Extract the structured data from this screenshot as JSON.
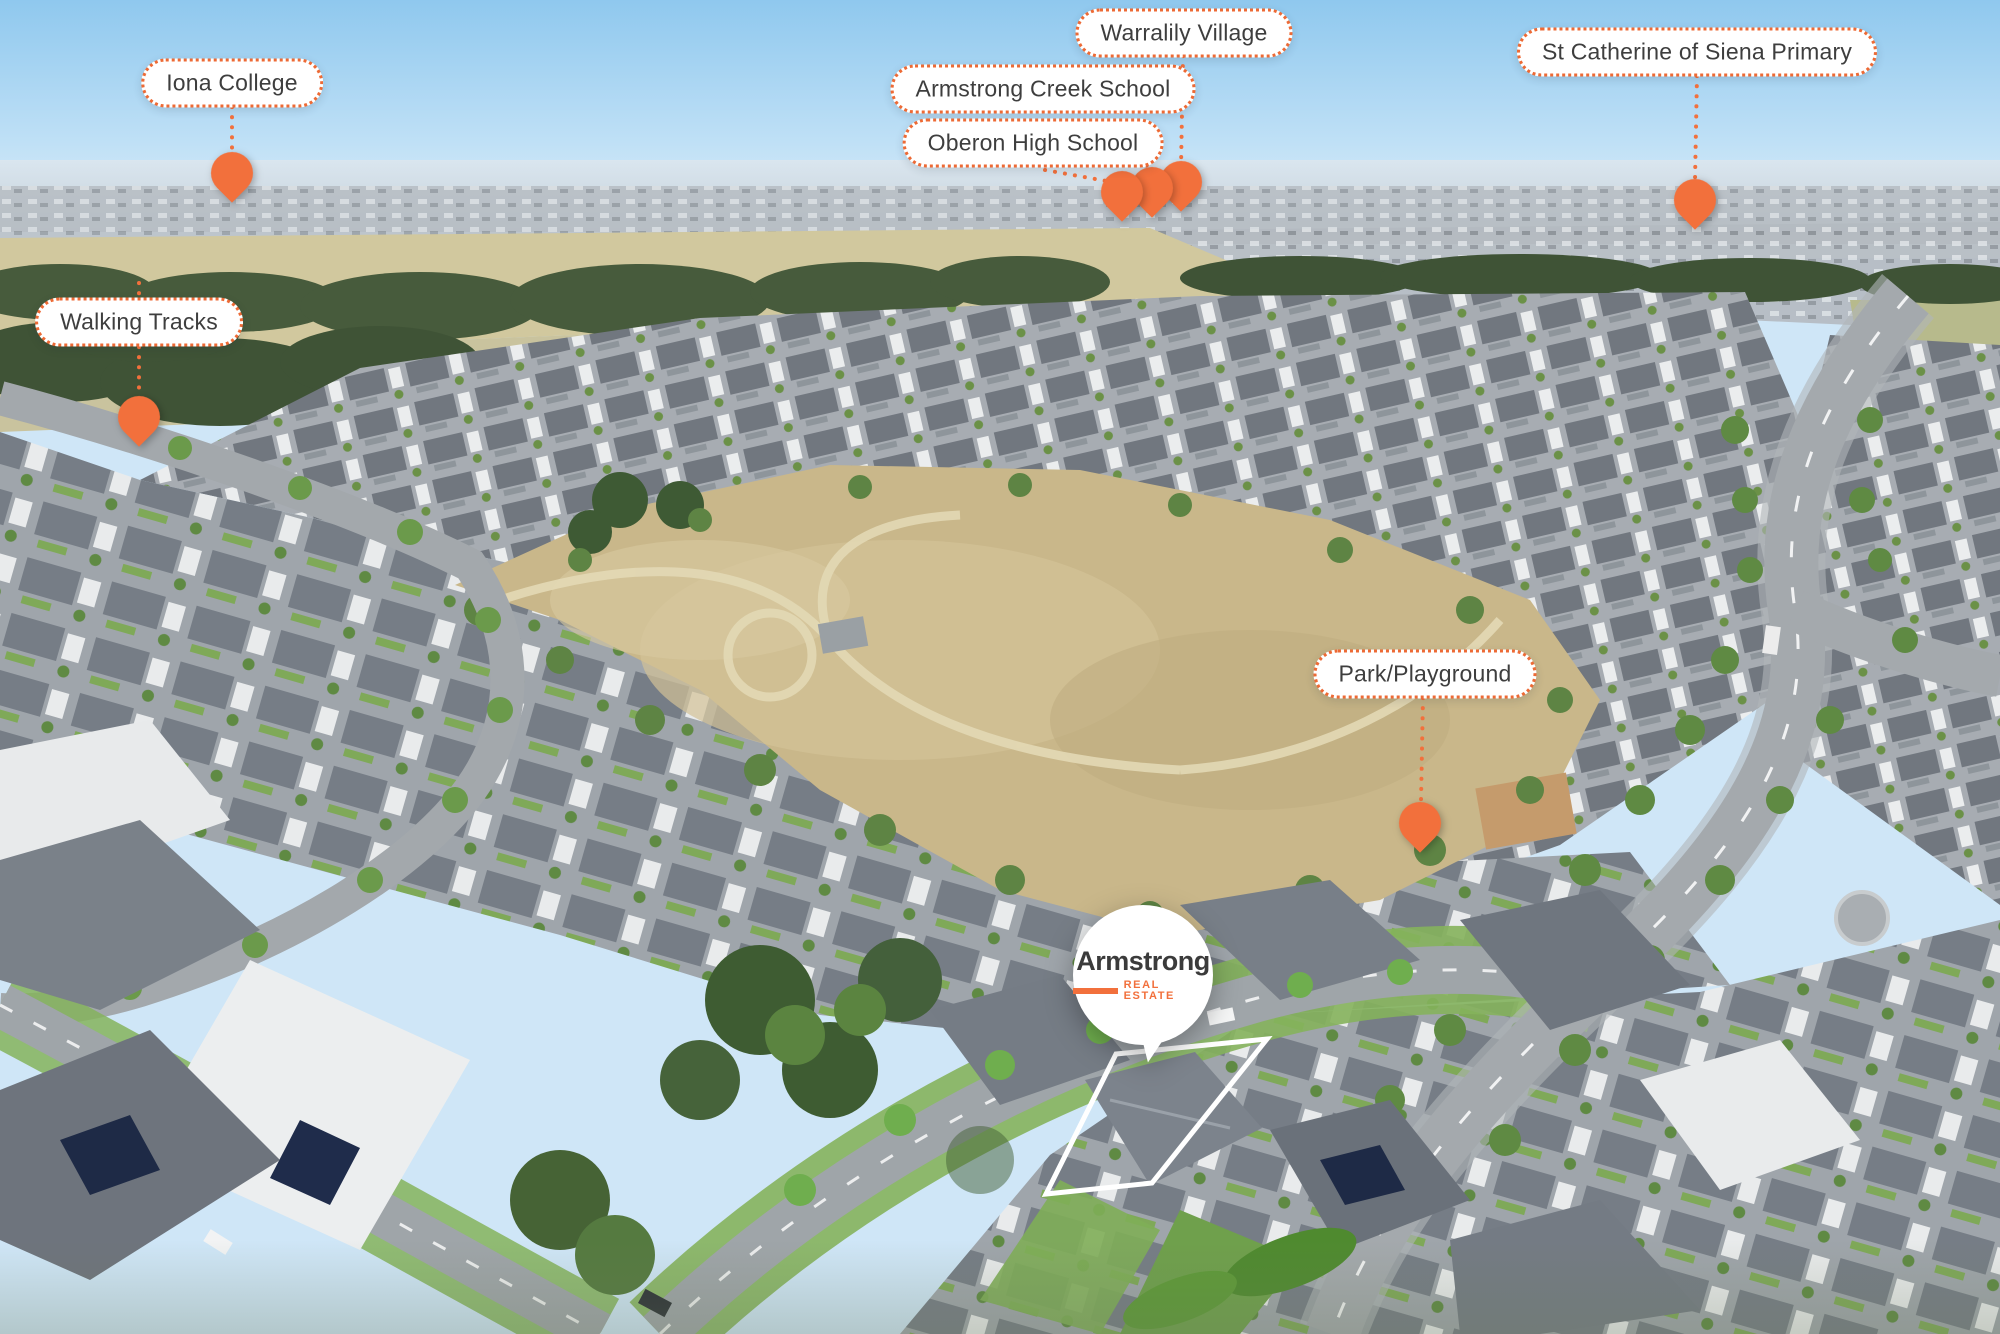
{
  "brand": {
    "name": "Armstrong",
    "tagline": "REAL ESTATE"
  },
  "labels": {
    "iona_college": "Iona College",
    "walking_tracks": "Walking Tracks",
    "oberon_high_school": "Oberon High School",
    "armstrong_creek_school": "Armstrong Creek School",
    "warralily_village": "Warralily Village",
    "st_catherine_primary": "St Catherine of Siena Primary",
    "park_playground": "Park/Playground"
  },
  "colors": {
    "accent_orange": "#F2703C",
    "label_border_orange": "#ED6A35",
    "label_text": "#3E3E3E",
    "logo_text_dark": "#3B3B3B",
    "pin_fill": "#F2703C"
  }
}
